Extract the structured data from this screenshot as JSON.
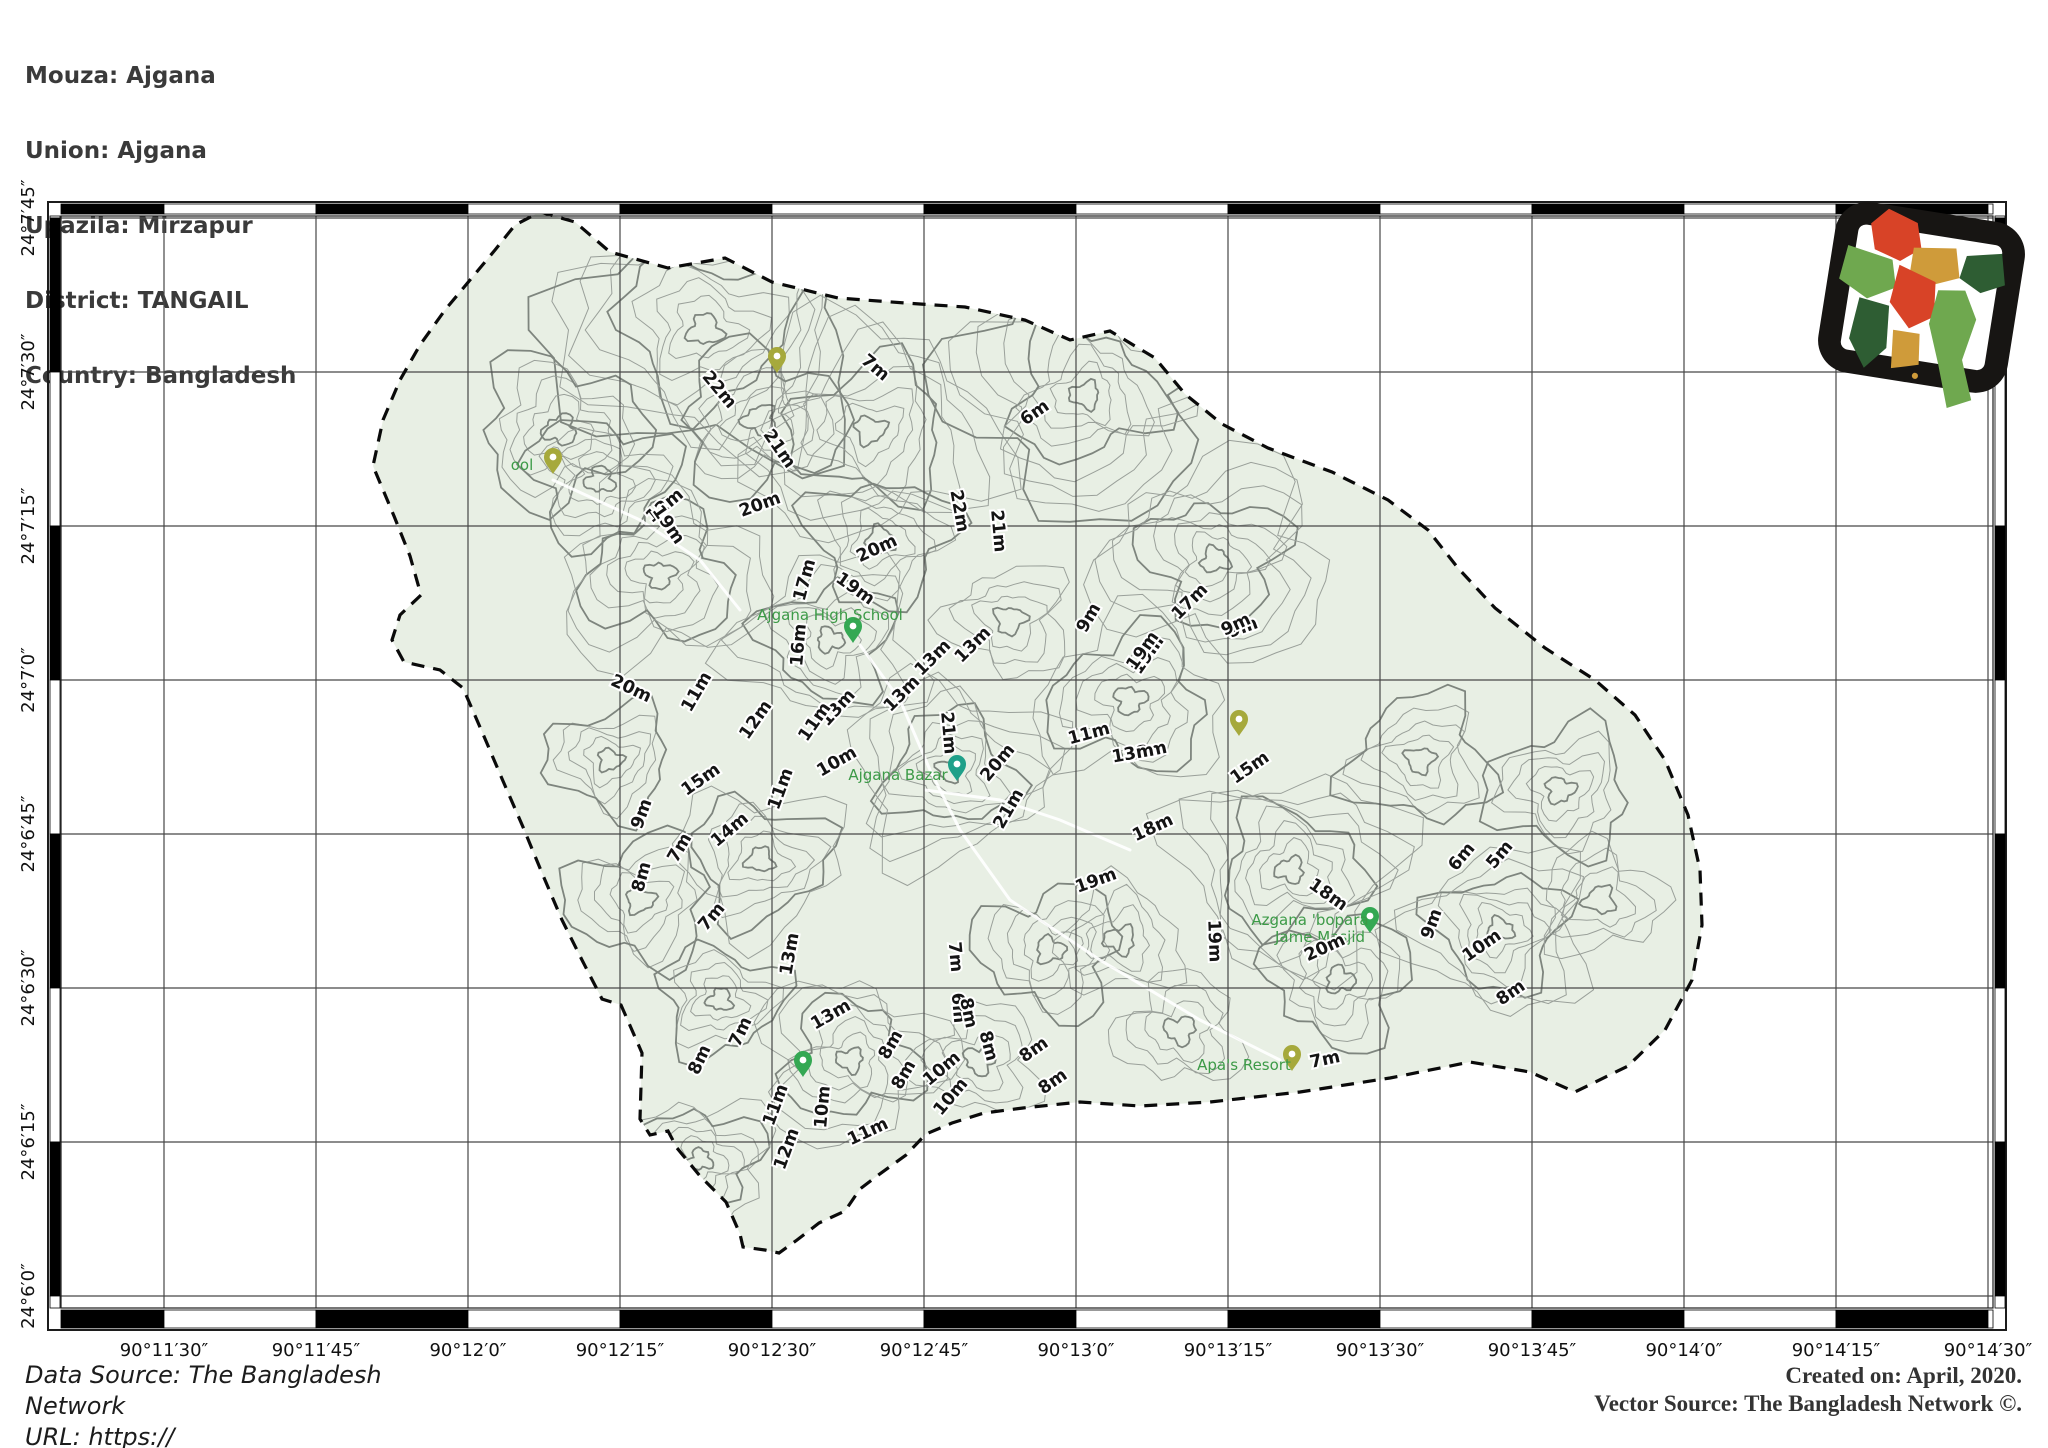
{
  "header": {
    "lines": [
      "Mouza: Ajgana",
      "Union: Ajgana",
      "Upazila: Mirzapur",
      "District: TANGAIL",
      "Country: Bangladesh"
    ]
  },
  "footer": {
    "left_lines": [
      "Data Source: The Bangladesh",
      "Network",
      "URL: https://"
    ],
    "right_lines": [
      "Created on: April, 2020.",
      "Vector Source: The Bangladesh Network ©."
    ]
  },
  "map": {
    "x_tick_labels": [
      "90°11′30″",
      "90°11′45″",
      "90°12′0″",
      "90°12′15″",
      "90°12′30″",
      "90°12′45″",
      "90°13′0″",
      "90°13′15″",
      "90°13′30″",
      "90°13′45″",
      "90°14′0″",
      "90°14′15″",
      "90°14′30″"
    ],
    "y_tick_labels": [
      "24°7′45″",
      "24°7′30″",
      "24°7′15″",
      "24°7′0″",
      "24°6′45″",
      "24°6′30″",
      "24°6′15″",
      "24°6′0″"
    ],
    "colors": {
      "land": "#e8efe4",
      "contour": "#9aa09a",
      "contour_index": "#7e857e",
      "boundary": "#0a0a0a",
      "grid": "#474747",
      "frame": "#1c1c1c",
      "poi_text": "#3c9a47",
      "pin_green": "#34a853",
      "pin_teal": "#1fa089",
      "pin_olive": "#a6a93c",
      "label_fill": "#141414",
      "label_halo": "#ffffff"
    },
    "boundary_polygon": [
      [
        540,
        212
      ],
      [
        575,
        222
      ],
      [
        610,
        252
      ],
      [
        668,
        268
      ],
      [
        725,
        258
      ],
      [
        772,
        282
      ],
      [
        838,
        298
      ],
      [
        905,
        303
      ],
      [
        965,
        307
      ],
      [
        1025,
        320
      ],
      [
        1070,
        340
      ],
      [
        1110,
        331
      ],
      [
        1155,
        358
      ],
      [
        1185,
        394
      ],
      [
        1222,
        424
      ],
      [
        1268,
        448
      ],
      [
        1332,
        472
      ],
      [
        1388,
        500
      ],
      [
        1428,
        530
      ],
      [
        1458,
        568
      ],
      [
        1495,
        608
      ],
      [
        1545,
        648
      ],
      [
        1595,
        680
      ],
      [
        1635,
        715
      ],
      [
        1665,
        760
      ],
      [
        1688,
        815
      ],
      [
        1700,
        870
      ],
      [
        1702,
        925
      ],
      [
        1692,
        980
      ],
      [
        1665,
        1030
      ],
      [
        1628,
        1066
      ],
      [
        1575,
        1092
      ],
      [
        1530,
        1072
      ],
      [
        1470,
        1062
      ],
      [
        1390,
        1078
      ],
      [
        1300,
        1092
      ],
      [
        1210,
        1102
      ],
      [
        1140,
        1106
      ],
      [
        1080,
        1102
      ],
      [
        1023,
        1108
      ],
      [
        984,
        1113
      ],
      [
        952,
        1123
      ],
      [
        926,
        1134
      ],
      [
        906,
        1155
      ],
      [
        877,
        1176
      ],
      [
        860,
        1189
      ],
      [
        845,
        1211
      ],
      [
        819,
        1223
      ],
      [
        797,
        1240
      ],
      [
        779,
        1253
      ],
      [
        765,
        1250
      ],
      [
        743,
        1247
      ],
      [
        740,
        1234
      ],
      [
        726,
        1202
      ],
      [
        700,
        1176
      ],
      [
        677,
        1148
      ],
      [
        668,
        1131
      ],
      [
        650,
        1135
      ],
      [
        640,
        1119
      ],
      [
        642,
        1053
      ],
      [
        621,
        1005
      ],
      [
        602,
        999
      ],
      [
        582,
        960
      ],
      [
        562,
        920
      ],
      [
        542,
        873
      ],
      [
        523,
        827
      ],
      [
        503,
        781
      ],
      [
        483,
        734
      ],
      [
        463,
        688
      ],
      [
        440,
        670
      ],
      [
        404,
        662
      ],
      [
        392,
        640
      ],
      [
        400,
        615
      ],
      [
        421,
        595
      ],
      [
        410,
        556
      ],
      [
        394,
        516
      ],
      [
        373,
        466
      ],
      [
        383,
        420
      ],
      [
        400,
        380
      ],
      [
        420,
        345
      ],
      [
        445,
        310
      ],
      [
        470,
        280
      ],
      [
        495,
        250
      ],
      [
        515,
        225
      ]
    ],
    "hills": [
      [
        705,
        330,
        150,
        9
      ],
      [
        870,
        430,
        120,
        8
      ],
      [
        1085,
        395,
        130,
        9
      ],
      [
        1215,
        560,
        110,
        8
      ],
      [
        660,
        575,
        100,
        7
      ],
      [
        560,
        430,
        80,
        5
      ],
      [
        830,
        640,
        90,
        7
      ],
      [
        950,
        770,
        100,
        8
      ],
      [
        760,
        860,
        80,
        6
      ],
      [
        640,
        900,
        70,
        5
      ],
      [
        850,
        1060,
        90,
        7
      ],
      [
        700,
        1160,
        70,
        6
      ],
      [
        1130,
        700,
        90,
        6
      ],
      [
        1290,
        870,
        110,
        8
      ],
      [
        1500,
        930,
        90,
        7
      ],
      [
        1420,
        760,
        70,
        5
      ],
      [
        1600,
        900,
        60,
        4
      ],
      [
        1050,
        950,
        70,
        5
      ],
      [
        1180,
        1030,
        60,
        4
      ],
      [
        600,
        480,
        70,
        5
      ],
      [
        1560,
        790,
        70,
        5
      ],
      [
        1120,
        940,
        60,
        4
      ],
      [
        880,
        540,
        70,
        5
      ],
      [
        1010,
        620,
        60,
        4
      ],
      [
        760,
        420,
        80,
        5
      ],
      [
        1340,
        980,
        70,
        5
      ],
      [
        980,
        1060,
        60,
        4
      ],
      [
        720,
        1000,
        60,
        5
      ],
      [
        610,
        760,
        60,
        5
      ]
    ],
    "roads": [
      [
        [
          860,
          645
        ],
        [
          900,
          700
        ],
        [
          930,
          770
        ],
        [
          960,
          830
        ],
        [
          1010,
          900
        ],
        [
          1100,
          960
        ],
        [
          1200,
          1020
        ],
        [
          1280,
          1060
        ]
      ],
      [
        [
          553,
          480
        ],
        [
          640,
          520
        ],
        [
          700,
          560
        ],
        [
          740,
          610
        ]
      ],
      [
        [
          925,
          790
        ],
        [
          1000,
          800
        ],
        [
          1060,
          820
        ],
        [
          1130,
          850
        ]
      ]
    ],
    "contour_labels": [
      [
        875,
        368,
        "7m",
        40
      ],
      [
        1035,
        413,
        "6m",
        -35
      ],
      [
        719,
        390,
        "22m",
        50
      ],
      [
        779,
        449,
        "21m",
        55
      ],
      [
        665,
        506,
        "12m",
        -40
      ],
      [
        668,
        525,
        "19m",
        55
      ],
      [
        760,
        505,
        "20m",
        -20
      ],
      [
        877,
        549,
        "20m",
        -25
      ],
      [
        855,
        589,
        "19m",
        35
      ],
      [
        805,
        580,
        "17m",
        -75
      ],
      [
        799,
        645,
        "16m",
        -85
      ],
      [
        959,
        511,
        "22m",
        80
      ],
      [
        998,
        531,
        "21m",
        85
      ],
      [
        1089,
        618,
        "9m",
        -60
      ],
      [
        1190,
        602,
        "17m",
        -45
      ],
      [
        1148,
        655,
        "19m",
        -55
      ],
      [
        1243,
        628,
        "9m",
        -20
      ],
      [
        973,
        645,
        "13m",
        -45
      ],
      [
        933,
        658,
        "13m",
        -45
      ],
      [
        902,
        694,
        "13m",
        -45
      ],
      [
        838,
        708,
        "13m",
        -48
      ],
      [
        631,
        689,
        "20m",
        25
      ],
      [
        697,
        692,
        "11m",
        -60
      ],
      [
        815,
        722,
        "11m",
        -55
      ],
      [
        837,
        762,
        "10m",
        -30
      ],
      [
        756,
        720,
        "12m",
        -55
      ],
      [
        781,
        789,
        "11m",
        -70
      ],
      [
        701,
        780,
        "15m",
        -35
      ],
      [
        642,
        814,
        "9m",
        -70
      ],
      [
        730,
        830,
        "14m",
        -40
      ],
      [
        680,
        848,
        "7m",
        -60
      ],
      [
        642,
        877,
        "8m",
        -75
      ],
      [
        712,
        917,
        "7m",
        -50
      ],
      [
        790,
        954,
        "13m",
        -80
      ],
      [
        948,
        733,
        "21m",
        85
      ],
      [
        998,
        763,
        "20m",
        -50
      ],
      [
        1009,
        809,
        "21m",
        -60
      ],
      [
        1089,
        734,
        "11m",
        -15
      ],
      [
        1146,
        752,
        "13m",
        -12
      ],
      [
        1250,
        768,
        "15m",
        -35
      ],
      [
        1096,
        881,
        "19m",
        -20
      ],
      [
        955,
        957,
        "7m",
        85
      ],
      [
        958,
        1008,
        "6m",
        85
      ],
      [
        988,
        1046,
        "8m",
        75
      ],
      [
        904,
        1075,
        "8m",
        -60
      ],
      [
        951,
        1097,
        "10m",
        -50
      ],
      [
        1053,
        1082,
        "8m",
        -35
      ],
      [
        700,
        1060,
        "8m",
        -65
      ],
      [
        741,
        1032,
        "7m",
        -65
      ],
      [
        1143,
        651,
        "19m",
        -55
      ],
      [
        1236,
        625,
        "9m",
        -25
      ],
      [
        1133,
        754,
        "13m",
        -10
      ],
      [
        1153,
        828,
        "18m",
        -25
      ],
      [
        1462,
        857,
        "6m",
        -50
      ],
      [
        1500,
        855,
        "5m",
        -50
      ],
      [
        1328,
        895,
        "18m",
        35
      ],
      [
        1432,
        924,
        "9m",
        -70
      ],
      [
        1482,
        946,
        "10m",
        -35
      ],
      [
        1511,
        993,
        "8m",
        -35
      ],
      [
        1214,
        941,
        "19m",
        88
      ],
      [
        1325,
        948,
        "20m",
        -25
      ],
      [
        1325,
        1060,
        "7m",
        -12
      ],
      [
        831,
        1015,
        "13m",
        -30
      ],
      [
        891,
        1045,
        "8m",
        -60
      ],
      [
        968,
        1013,
        "8m",
        78
      ],
      [
        942,
        1069,
        "10m",
        -40
      ],
      [
        1034,
        1050,
        "8m",
        -35
      ],
      [
        776,
        1105,
        "11m",
        -70
      ],
      [
        823,
        1107,
        "10m",
        -85
      ],
      [
        868,
        1132,
        "11m",
        -25
      ],
      [
        787,
        1149,
        "12m",
        -70
      ]
    ],
    "pois": [
      {
        "pin": "green",
        "x": 853,
        "y": 643,
        "label": "Ajgana High School",
        "lx": 830,
        "ly": 620
      },
      {
        "pin": "teal",
        "x": 957,
        "y": 781,
        "label": "Ajgana Bazar",
        "lx": 898,
        "ly": 780
      },
      {
        "pin": "green",
        "x": 1370,
        "y": 933,
        "label": "Azgana 'bopara",
        "label2": "Jame Masjid",
        "lx": 1310,
        "ly": 925
      },
      {
        "pin": "olive",
        "x": 1292,
        "y": 1071,
        "label": "Apa's Resort",
        "lx": 1244,
        "ly": 1070
      },
      {
        "pin": "olive",
        "x": 553,
        "y": 474,
        "label": "ool",
        "lx": 522,
        "ly": 470
      },
      {
        "pin": "olive",
        "x": 777,
        "y": 373,
        "label": "",
        "lx": 0,
        "ly": 0
      },
      {
        "pin": "olive",
        "x": 1239,
        "y": 736,
        "label": "",
        "lx": 0,
        "ly": 0
      },
      {
        "pin": "green",
        "x": 803,
        "y": 1077,
        "label": "",
        "lx": 0,
        "ly": 0
      }
    ]
  },
  "inset": {
    "colors": {
      "frame": "#171513",
      "red": "#d84327",
      "light_green": "#6fa84f",
      "dark_green": "#2e5d33",
      "gold": "#cf9b3a"
    }
  }
}
